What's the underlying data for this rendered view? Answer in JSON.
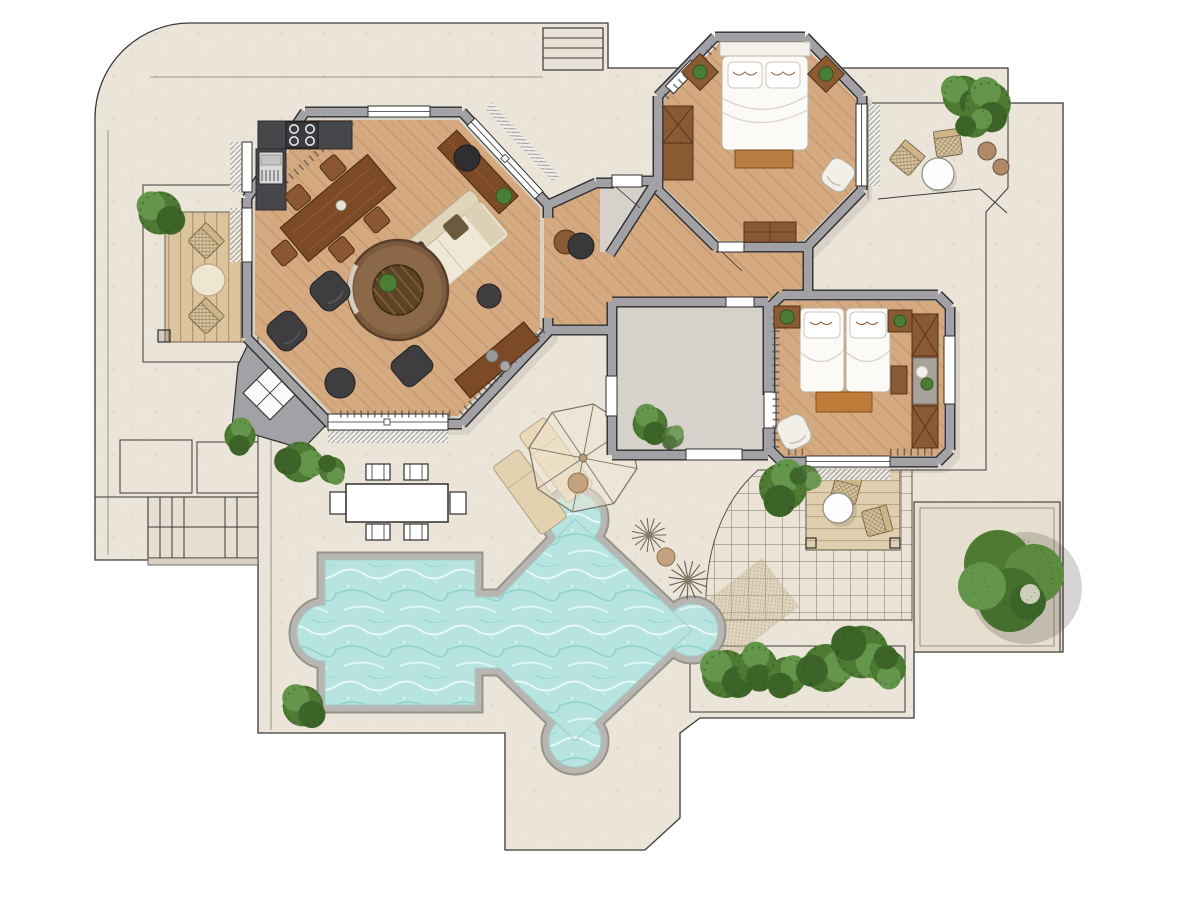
{
  "meta": {
    "title": "Villa floor plan — top-view architectural rendering with pool terrace"
  },
  "palette": {
    "page_bg": "#ffffff",
    "terrace": "#ebe5d9",
    "terrace_line": "#3a3a38",
    "wall": "#a2a2a6",
    "wall_edge": "#2d2d2f",
    "wood_floor_base": "#d5aa80",
    "gray_floor": "#d6d1ca",
    "counter": "#46474a",
    "water_base": "#b7e4e1",
    "coping": "#b8b6b1",
    "coping_rim": "#95938c",
    "water_edge": "#9fcfcb",
    "deck_base": "#dcc49e",
    "cream": "#f0e8d6",
    "dark_seat": "#3e3e40",
    "white_bed": "#fbfaf7",
    "wood_dark": "#8a5a33",
    "wood_edge": "#53331a",
    "bench": "#b97d42",
    "green": "#4e7a33",
    "green_light": "#63954a",
    "green_dark": "#3c6328",
    "tan": "#c2a37e",
    "tile_line": "#837c6e",
    "line_soft": "#6b675f"
  },
  "rooms": [
    {
      "id": "living-room",
      "label": "Living / dining room (octagonal)",
      "floor": "wood planks"
    },
    {
      "id": "kitchen",
      "label": "Kitchen corner with hob and fridge",
      "floor": "wood planks"
    },
    {
      "id": "entry-hall",
      "label": "Entry vestibule",
      "floor": "stone"
    },
    {
      "id": "hallway",
      "label": "Hallway",
      "floor": "wood planks"
    },
    {
      "id": "bathroom",
      "label": "Bathroom / utility room",
      "floor": "stone"
    },
    {
      "id": "bedroom-1",
      "label": "Bedroom 1 (octagonal, double bed)",
      "floor": "wood planks"
    },
    {
      "id": "bedroom-2",
      "label": "Bedroom 2 (twin beds)",
      "floor": "wood planks"
    }
  ],
  "outdoor": {
    "pool": {
      "label": "Free-form swimming pool with rounded lobes"
    },
    "pool_terrace": {
      "label": "Paved sun terrace"
    },
    "outdoor_dining": {
      "label": "Outdoor dining table with six chairs"
    },
    "parasol": {
      "label": "Parasol with two sun loungers and pouf"
    },
    "left_deck": {
      "label": "West timber deck with bistro table and two wicker chairs"
    },
    "pergola_patio": {
      "label": "East pergola deck with round table and two wicker chairs"
    },
    "ne_patio": {
      "label": "North-east bistro corner with round table, wicker chairs and potted plants"
    },
    "tiled_patio": {
      "label": "Grid-tiled patio"
    },
    "lawn": {
      "label": "Lawn / planting panel"
    },
    "hedge": {
      "label": "Hedge planter with shrubs"
    },
    "stairs_top": {
      "label": "Entry steps (north)"
    },
    "stairs_sw": {
      "label": "Garden steps (south-west)"
    },
    "big_tree": {
      "label": "Large garden tree"
    }
  },
  "furniture": {
    "living_room": [
      "dining table with five chairs",
      "cream sofa with cushions",
      "round rug",
      "round wood coffee table with plant",
      "two dark armchairs",
      "two dark poufs",
      "dark ottoman",
      "sideboard with chair",
      "low console with decor"
    ],
    "kitchen": [
      "L-shaped dark counter",
      "four-burner hob",
      "fridge"
    ],
    "bedroom_1": [
      "double bed with two pillows",
      "headboard",
      "foot bench",
      "two nightstands with plants",
      "wardrobe",
      "white chair",
      "dresser"
    ],
    "bedroom_2": [
      "two single beds with pillows",
      "foot bench",
      "two nightstands with plants",
      "tall wardrobe",
      "desk",
      "white armchair"
    ],
    "entry_hall": [
      "console with round stool"
    ]
  }
}
